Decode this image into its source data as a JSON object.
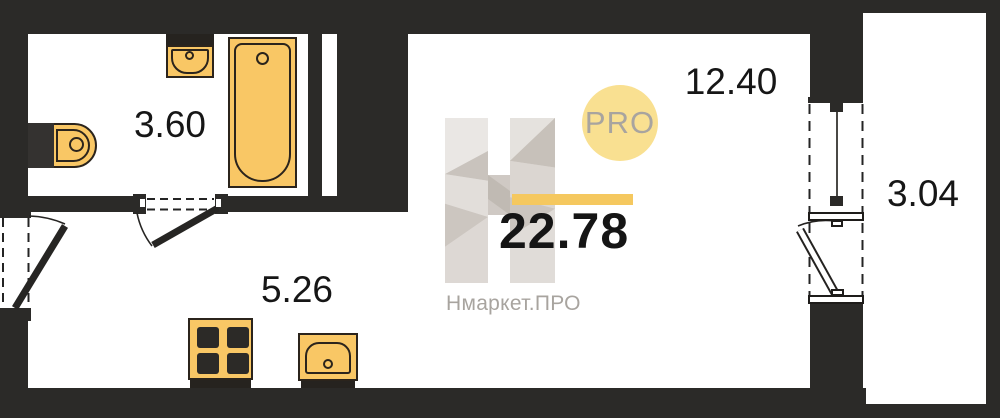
{
  "plan": {
    "title": "Studio apartment floor plan",
    "total_area": "22.78",
    "rooms": [
      {
        "name": "bathroom",
        "area": "3.60"
      },
      {
        "name": "main-room",
        "area": "12.40"
      },
      {
        "name": "kitchen-zone",
        "area": "5.26"
      },
      {
        "name": "balcony",
        "area": "3.04"
      }
    ],
    "fixtures": [
      "toilet",
      "washbasin",
      "bathtub",
      "stove",
      "kitchen-sink"
    ],
    "colors": {
      "wall": "#2B2A28",
      "fixture_fill": "#F9C765",
      "fixture_outline": "#2B241C",
      "floor": "#FFFFFF"
    }
  },
  "watermark": {
    "logo_letter": "H",
    "badge": "PRO",
    "brand": "Нмаркет.ПРО",
    "colors": {
      "badge_bg": "#F9E091",
      "badge_text": "#A8A49F",
      "accent_bar": "#F5C85F",
      "logo_gray": "#D8D4D0",
      "brand_text": "#A8A49F",
      "area_text": "#151515"
    }
  }
}
